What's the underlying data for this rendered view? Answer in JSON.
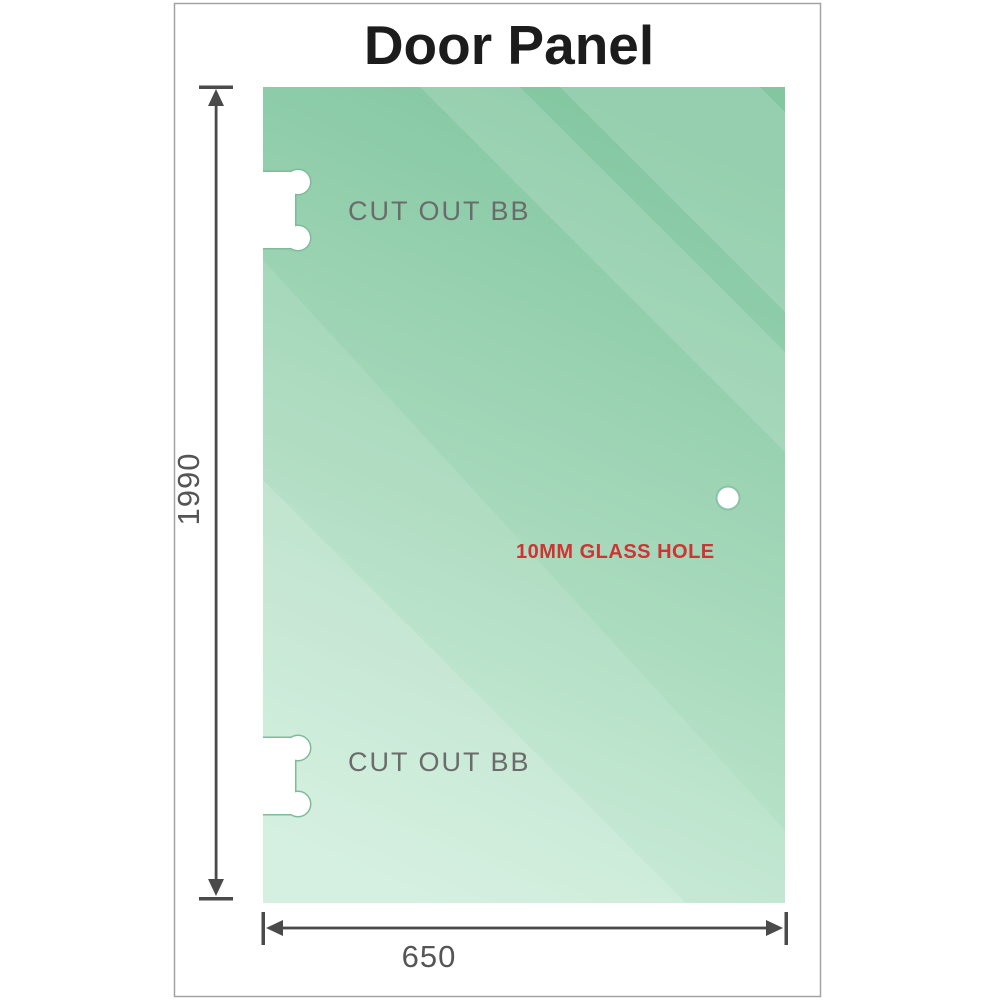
{
  "title": "Door Panel",
  "labels": {
    "cutout_top": "CUT OUT BB",
    "cutout_bottom": "CUT OUT BB",
    "glass_hole": "10MM GLASS HOLE",
    "width_dimension": "650",
    "height_dimension": "1990"
  },
  "colors": {
    "frame_border": "#a3a3a3",
    "glass_gradient_top": "#83c7a1",
    "glass_gradient_mid": "#a9dabd",
    "glass_gradient_bottom": "#c9ecd8",
    "cutout_outline": "#7fbb9b",
    "hole_outline": "#8ac3a6",
    "dimension_lines": "#4a4a4a",
    "dimension_text": "#555555",
    "cutout_label_text": "#6b6b6b",
    "glass_hole_text": "#cf3333",
    "title_text": "#1c1c1c"
  }
}
